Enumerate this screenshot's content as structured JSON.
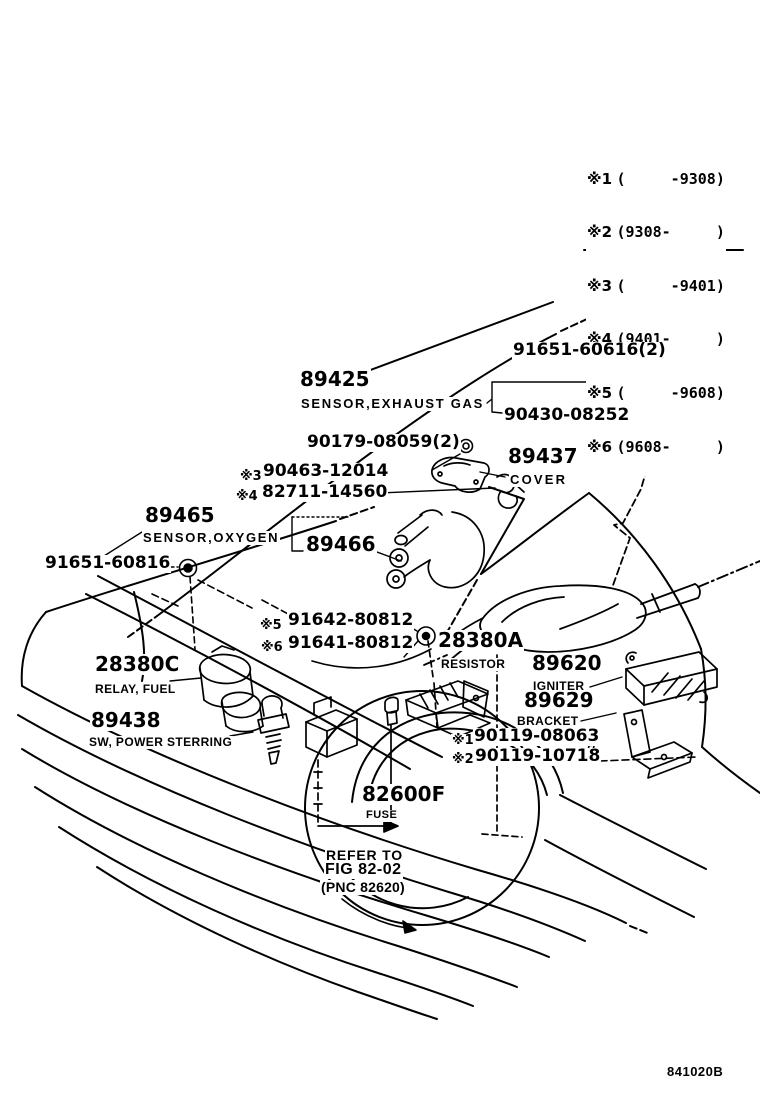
{
  "page": {
    "background": "#ffffff",
    "ink": "#000000",
    "doc_code": "841020B"
  },
  "notes_table": {
    "rows": [
      {
        "ref": "※1",
        "range": "(     -9308)"
      },
      {
        "ref": "※2",
        "range": "(9308-     )"
      },
      {
        "ref": "※3",
        "range": "(     -9401)"
      },
      {
        "ref": "※4",
        "range": "(9401-     )"
      },
      {
        "ref": "※5",
        "range": "(     -9608)"
      },
      {
        "ref": "※6",
        "range": "(9608-     )"
      }
    ]
  },
  "callouts": {
    "c91651_60616": {
      "num": "91651-60616(2)"
    },
    "c89425": {
      "num": "89425",
      "name": "SENSOR,EXHAUST GAS"
    },
    "c90430_08252": {
      "num": "90430-08252"
    },
    "c90179_08059": {
      "num": "90179-08059(2)"
    },
    "c90463_12014": {
      "prefix": "※3",
      "num": "90463-12014"
    },
    "c82711_14560": {
      "prefix": "※4",
      "num": "82711-14560"
    },
    "c89437": {
      "num": "89437",
      "name": "COVER"
    },
    "c89465": {
      "num": "89465",
      "name": "SENSOR,OXYGEN"
    },
    "c89466": {
      "num": "89466"
    },
    "c91651_60816": {
      "num": "91651-60816"
    },
    "c91642_80812": {
      "prefix": "※5",
      "num": "91642-80812"
    },
    "c91641_80812": {
      "prefix": "※6",
      "num": "91641-80812"
    },
    "c28380A": {
      "num": "28380A",
      "name": "RESISTOR"
    },
    "c28380C": {
      "num": "28380C",
      "name": "RELAY, FUEL"
    },
    "c89438": {
      "num": "89438",
      "name": "SW, POWER STERRING"
    },
    "c89620": {
      "num": "89620",
      "name": "IGNITER"
    },
    "c89629": {
      "num": "89629",
      "name": "BRACKET"
    },
    "c90119_08063": {
      "prefix": "※1",
      "num": "90119-08063"
    },
    "c90119_10718": {
      "prefix": "※2",
      "num": "90119-10718"
    },
    "c82600F": {
      "num": "82600F",
      "name": "FUSE"
    }
  },
  "reference_note": {
    "line1": "REFER TO",
    "line2": "FIG 82-02",
    "line3": "(PNC 82620)"
  }
}
